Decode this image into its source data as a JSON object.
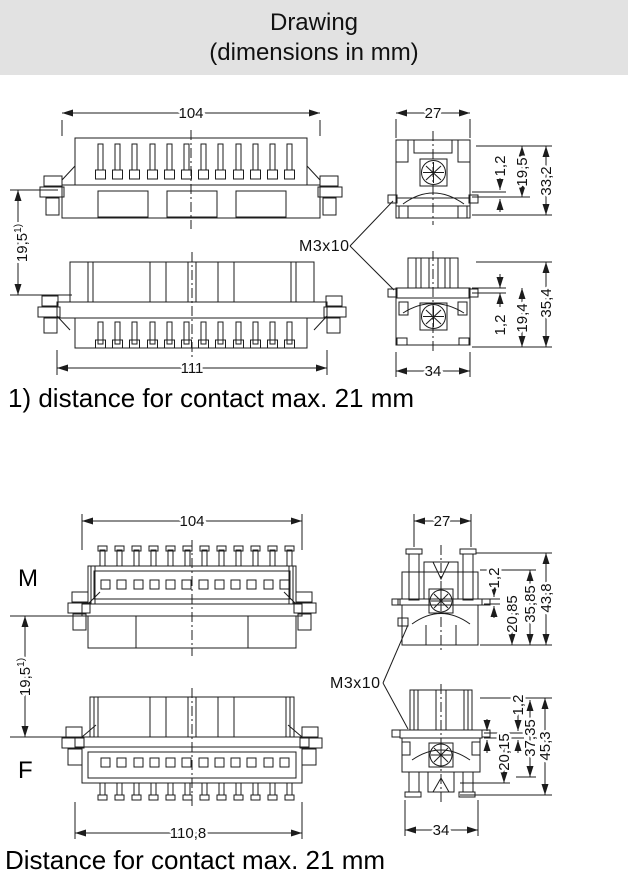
{
  "header": {
    "line1": "Drawing",
    "line2": "(dimensions in mm)"
  },
  "note_upper": "1) distance for contact max. 21 mm",
  "note_lower": "Distance for contact max. 21 mm",
  "upper_drawing": {
    "front_view_width": "104",
    "bottom_view_width": "111",
    "face_distance": {
      "value": "19,5",
      "note_ref": "1)"
    },
    "thread_label": "M3x10",
    "side_top": {
      "width": "27",
      "flange_thickness": "1,2",
      "insert_height": "19,5",
      "total_height": "33,2"
    },
    "side_bottom": {
      "flange_thickness": "1,2",
      "insert_height": "19,4",
      "total_height": "35,4",
      "width": "34"
    }
  },
  "lower_drawing": {
    "male_label": "M",
    "female_label": "F",
    "male_view_width": "104",
    "female_view_width": "110,8",
    "face_distance": {
      "value": "19,5",
      "note_ref": "1)"
    },
    "thread_label": "M3x10",
    "side_top": {
      "width": "27",
      "flange_thickness": "1,2",
      "height_inner": "20,85",
      "height_mid": "35,85",
      "total_height": "43,8"
    },
    "side_bottom": {
      "flange_thickness": "1,2",
      "height_inner": "20,15",
      "height_mid": "37,35",
      "total_height": "45,3",
      "width": "34"
    }
  }
}
